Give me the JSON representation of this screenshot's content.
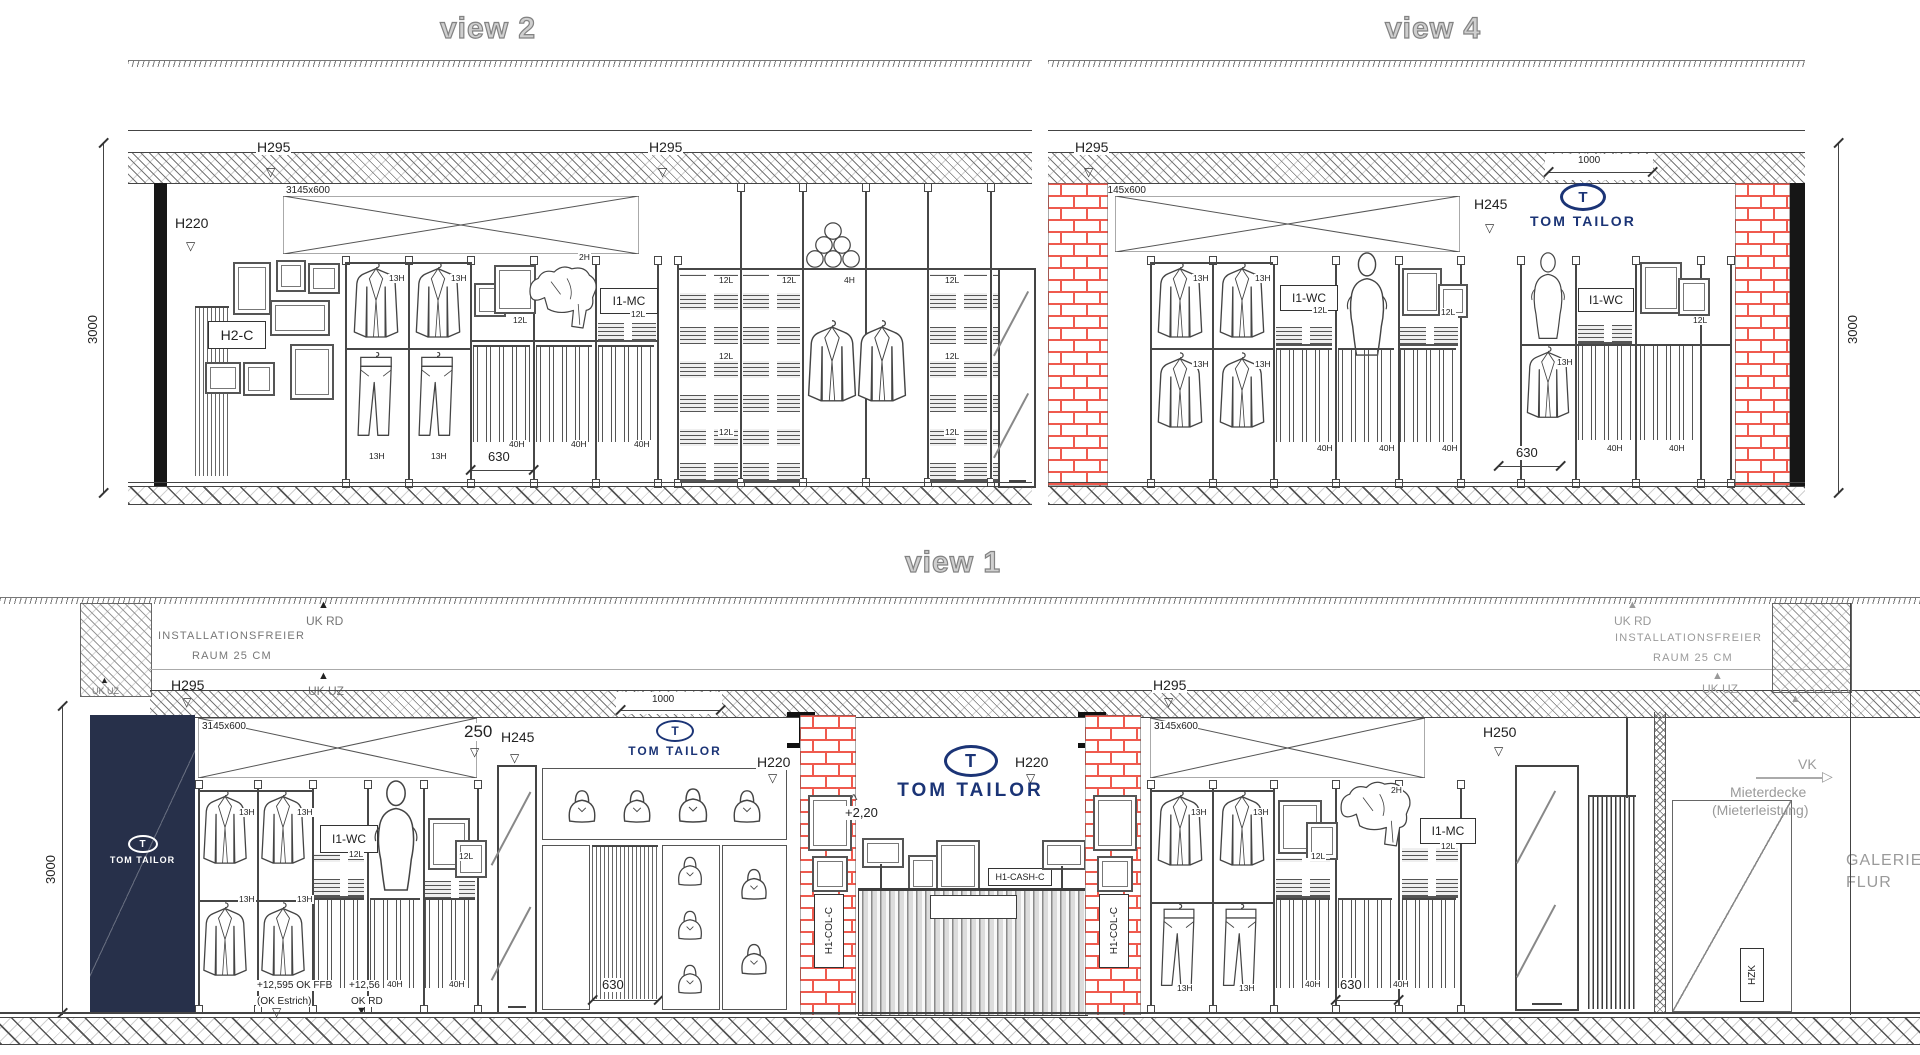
{
  "titles": {
    "view2": "view 2",
    "view4": "view 4",
    "view1": "view 1"
  },
  "brand": {
    "t": "T",
    "name": "TOM TAILOR"
  },
  "dims": {
    "d3000": "3000",
    "d3145": "3145x600",
    "d1000": "1000",
    "d630": "630",
    "d250": "250"
  },
  "heights": {
    "h295": "H295",
    "h220": "H220",
    "h245": "H245",
    "h250": "H250",
    "h13": "13H",
    "h40": "40H",
    "h2": "2H",
    "h4": "4H",
    "l12": "12L"
  },
  "tags": {
    "h2c": "H2-C",
    "i1mc": "I1-MC",
    "i1wc": "I1-WC",
    "h1col": "H1-COL-C",
    "h1cash": "H1-CASH-C",
    "hzk": "HZK"
  },
  "annotations": {
    "install1": "INSTALLATIONSFREIER",
    "install2": "RAUM 25 CM",
    "ukrd": "UK RD",
    "ukuz": "UK UZ",
    "vk": "VK",
    "mieterdecke": "Mieterdecke",
    "mieterleistung": "(Mieterleistung)",
    "galerie": "GALERIE",
    "flur": "FLUR",
    "level_ffb": "+12,595 OK FFB",
    "level_estrich": "(OK Estrich)",
    "level_rd": "+12,56",
    "level_okrd": "OK RD",
    "f220": "+2,20",
    "tri_down": "▽",
    "tri_down_f": "▼",
    "tri_up_f": "▲",
    "arrow_r": "▷",
    "roof": "^"
  },
  "colors": {
    "brick": "#ef5a4e",
    "navy_panel": "#27304a",
    "logo_navy": "#1b3476",
    "annotation_gray": "#9a9a9a",
    "line": "#444444"
  }
}
